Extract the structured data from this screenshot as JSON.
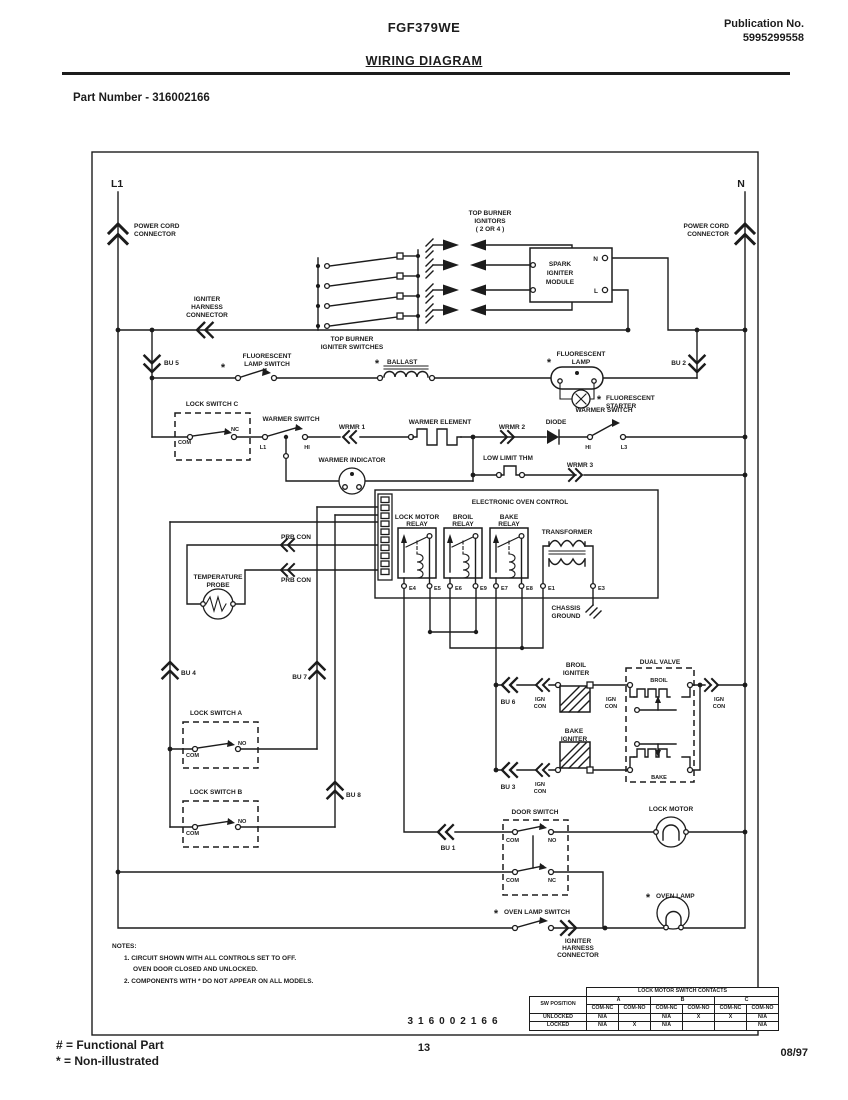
{
  "header": {
    "model": "FGF379WE",
    "publication_label": "Publication No.",
    "publication_number": "5995299558",
    "title": "WIRING DIAGRAM",
    "part_number": "Part Number - 316002166"
  },
  "footer": {
    "functional_part": "# = Functional Part",
    "non_illustrated": "* = Non-illustrated",
    "page_number": "13",
    "date": "08/97"
  },
  "diagram": {
    "number": "316002166",
    "star": "*",
    "l1": "L1",
    "n": "N",
    "power_cord": [
      "POWER CORD",
      "CONNECTOR"
    ],
    "igniter_harness": [
      "IGNITER",
      "HARNESS",
      "CONNECTOR"
    ],
    "top_burner_switches": [
      "TOP BURNER",
      "IGNITER SWITCHES"
    ],
    "top_burner_ignitors": [
      "TOP BURNER",
      "IGNITORS",
      "( 2 OR 4 )"
    ],
    "spark_module": [
      "SPARK",
      "IGNITER",
      "MODULE"
    ],
    "terminal_n": "N",
    "terminal_l": "L",
    "bu1": "BU 1",
    "bu2": "BU 2",
    "bu3": "BU 3",
    "bu4": "BU 4",
    "bu5": "BU 5",
    "bu6": "BU 6",
    "bu7": "BU 7",
    "bu8": "BU 8",
    "fluorescent_lamp_switch": [
      "FLUORESCENT",
      "LAMP SWITCH"
    ],
    "ballast": "BALLAST",
    "fluorescent_lamp": [
      "FLUORESCENT",
      "LAMP"
    ],
    "fluorescent_starter": [
      "FLUORESCENT",
      "STARTER"
    ],
    "lock_switch_c": "LOCK SWITCH C",
    "lock_switch_a": "LOCK SWITCH A",
    "lock_switch_b": "LOCK SWITCH B",
    "warmer_switch": "WARMER SWITCH",
    "warmer_element": "WARMER ELEMENT",
    "warmer_indicator": "WARMER INDICATOR",
    "wrmr1": "WRMR 1",
    "wrmr2": "WRMR 2",
    "wrmr3": "WRMR 3",
    "diode": "DIODE",
    "low_limit_thm": "LOW LIMIT THM",
    "com": "COM",
    "nc": "NC",
    "no": "NO",
    "hi": "HI",
    "l1_terminal": "L1",
    "l3": "L3",
    "eoc_title": "ELECTRONIC OVEN CONTROL",
    "lock_motor_relay": [
      "LOCK MOTOR",
      "RELAY"
    ],
    "broil_relay": [
      "BROIL",
      "RELAY"
    ],
    "bake_relay": [
      "BAKE",
      "RELAY"
    ],
    "transformer": "TRANSFORMER",
    "chassis_ground": [
      "CHASSIS",
      "GROUND"
    ],
    "e1": "E1",
    "e3": "E3",
    "e4": "E4",
    "e5": "E5",
    "e6": "E6",
    "e7": "E7",
    "e8": "E8",
    "e9": "E9",
    "prb_con": "PRB CON",
    "temperature_probe": [
      "TEMPERATURE",
      "PROBE"
    ],
    "broil_igniter": [
      "BROIL",
      "IGNITER"
    ],
    "bake_igniter": [
      "BAKE",
      "IGNITER"
    ],
    "ign_con": [
      "IGN",
      "CON"
    ],
    "dual_valve": "DUAL VALVE",
    "broil": "BROIL",
    "bake": "BAKE",
    "door_switch": "DOOR SWITCH",
    "lock_motor": "LOCK MOTOR",
    "oven_lamp_switch": "OVEN LAMP SWITCH",
    "oven_lamp": "OVEN LAMP",
    "notes": [
      "NOTES:",
      "1. CIRCUIT SHOWN WITH ALL CONTROLS SET TO OFF.",
      "OVEN DOOR CLOSED AND UNLOCKED.",
      "2. COMPONENTS WITH * DO NOT APPEAR ON ALL MODELS."
    ]
  },
  "contacts_table": {
    "title": "LOCK MOTOR SWITCH CONTACTS",
    "position_header": "SW POSITION",
    "groups": [
      "A",
      "B",
      "C"
    ],
    "contact_headers": [
      "COM-NC",
      "COM-NO",
      "COM-NC",
      "COM-NO",
      "COM-NC",
      "COM-NO"
    ],
    "rows": [
      {
        "position": "UNLOCKED",
        "cells": [
          "N/A",
          "",
          "N/A",
          "X",
          "X",
          "N/A"
        ]
      },
      {
        "position": "LOCKED",
        "cells": [
          "N/A",
          "X",
          "N/A",
          "",
          "",
          "N/A"
        ]
      }
    ]
  },
  "colors": {
    "ink": "#1c1c1c",
    "paper": "#ffffff"
  }
}
